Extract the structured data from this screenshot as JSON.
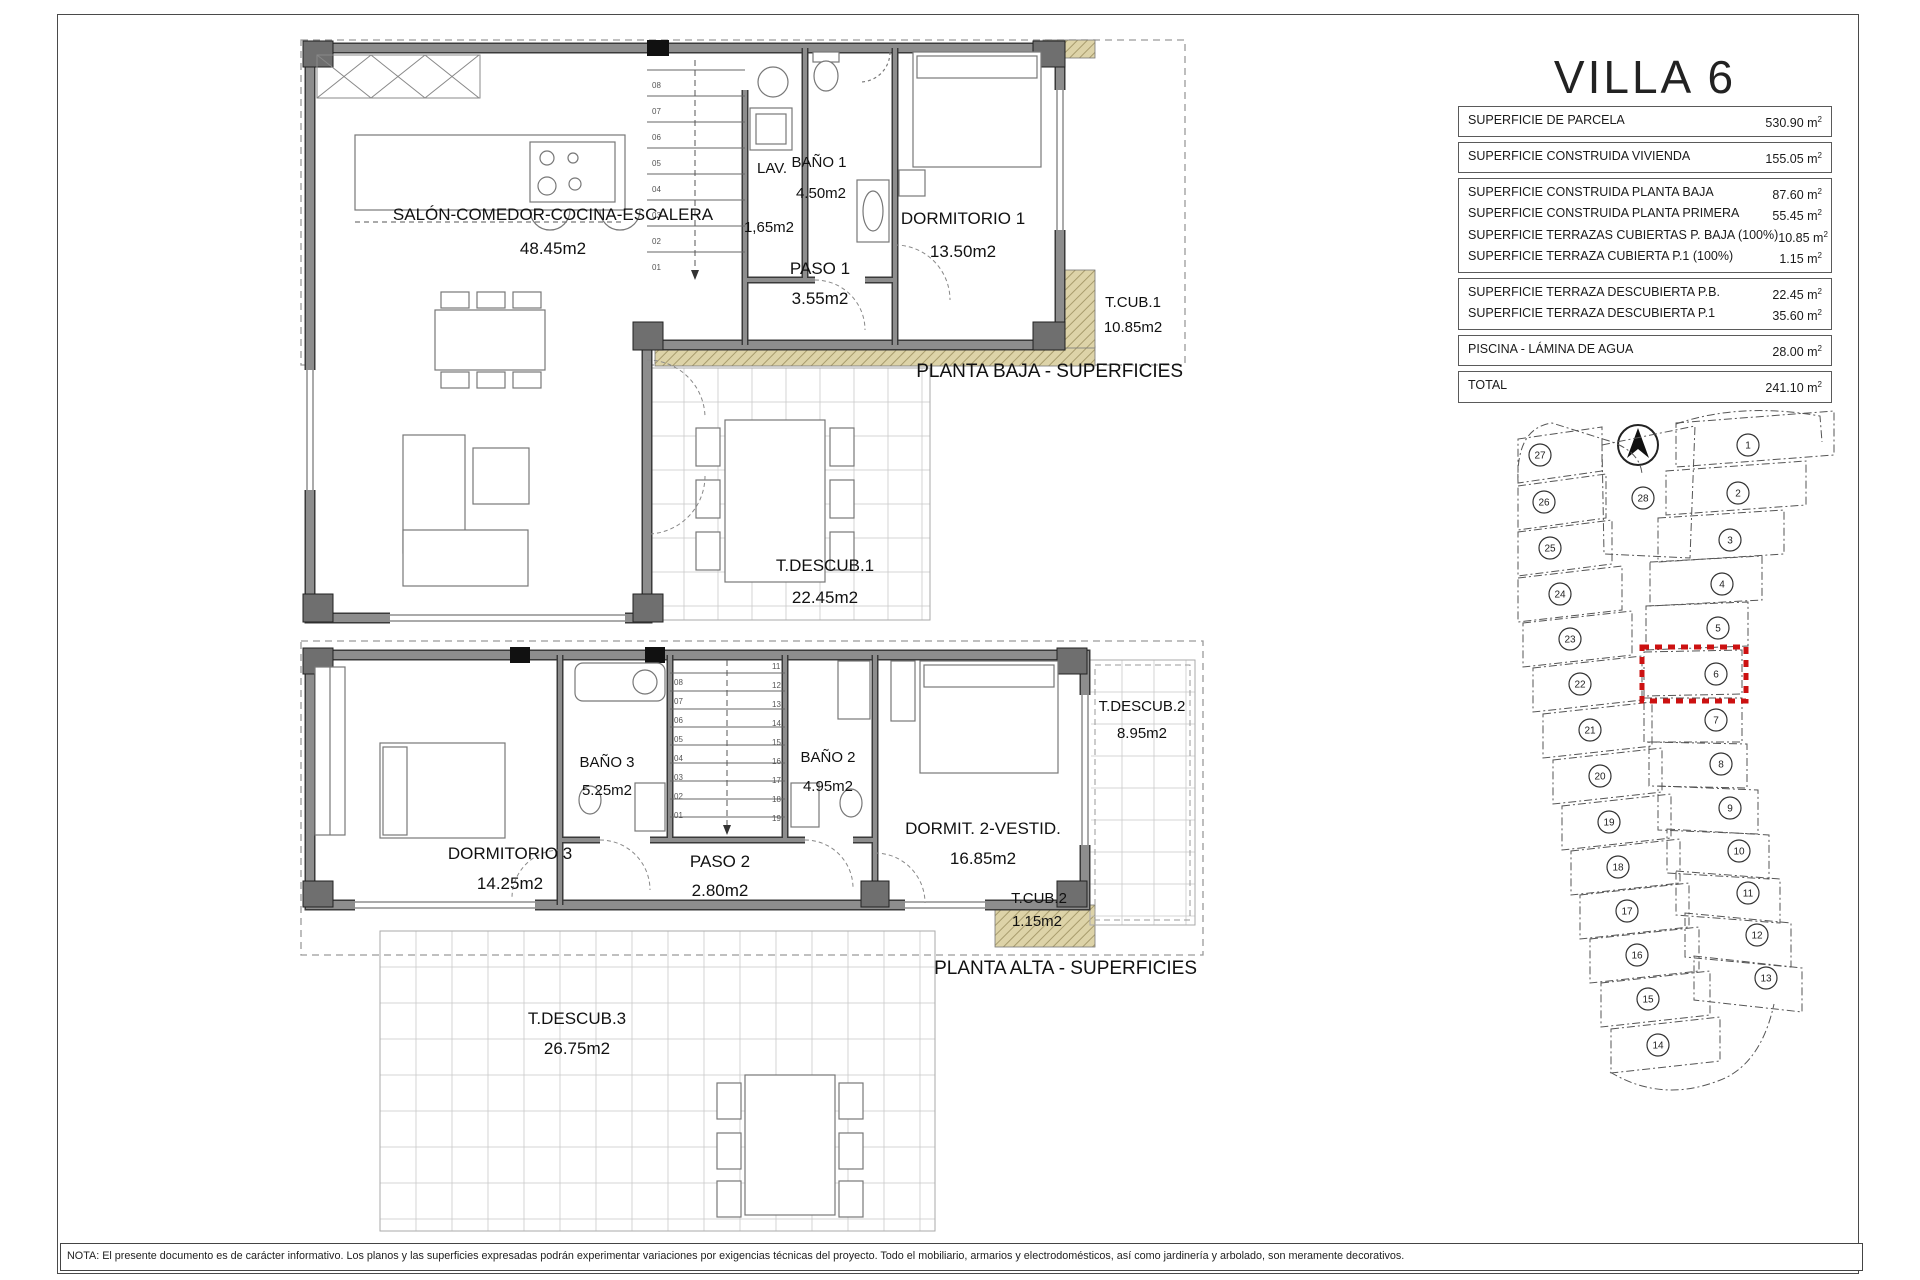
{
  "title": "VILLA 6",
  "table": {
    "unit_suffix": "m",
    "groups": [
      {
        "rows": [
          {
            "label": "SUPERFICIE DE PARCELA",
            "value": "530.90"
          }
        ]
      },
      {
        "rows": [
          {
            "label": "SUPERFICIE CONSTRUIDA VIVIENDA",
            "value": "155.05"
          }
        ]
      },
      {
        "rows": [
          {
            "label": "SUPERFICIE CONSTRUIDA PLANTA BAJA",
            "value": "87.60"
          },
          {
            "label": "SUPERFICIE CONSTRUIDA PLANTA PRIMERA",
            "value": "55.45"
          },
          {
            "label": "SUPERFICIE TERRAZAS CUBIERTAS P. BAJA (100%)",
            "value": "10.85"
          },
          {
            "label": "SUPERFICIE TERRAZA CUBIERTA P.1 (100%)",
            "value": "1.15"
          }
        ]
      },
      {
        "rows": [
          {
            "label": "SUPERFICIE TERRAZA DESCUBIERTA P.B.",
            "value": "22.45"
          },
          {
            "label": "SUPERFICIE TERRAZA DESCUBIERTA P.1",
            "value": "35.60"
          }
        ]
      },
      {
        "rows": [
          {
            "label": "PISCINA - LÁMINA DE AGUA",
            "value": "28.00"
          }
        ]
      },
      {
        "rows": [
          {
            "label": "TOTAL",
            "value": "241.10"
          }
        ]
      }
    ]
  },
  "plans": {
    "baja": {
      "caption": "PLANTA BAJA - SUPERFICIES",
      "rooms": {
        "salon": {
          "name": "SALÓN-COMEDOR-COCINA-ESCALERA",
          "area": "48.45m2"
        },
        "lav": {
          "name": "LAV.",
          "area": "1,65m2"
        },
        "bano1": {
          "name": "BAÑO 1",
          "area": "4.50m2"
        },
        "paso1": {
          "name": "PASO 1",
          "area": "3.55m2"
        },
        "dormitorio1": {
          "name": "DORMITORIO 1",
          "area": "13.50m2"
        },
        "tcub1": {
          "name": "T.CUB.1",
          "area": "10.85m2"
        },
        "tdescub1": {
          "name": "T.DESCUB.1",
          "area": "22.45m2"
        }
      },
      "stair_numbers": [
        "01",
        "02",
        "03",
        "04",
        "05",
        "06",
        "07",
        "08"
      ]
    },
    "alta": {
      "caption": "PLANTA ALTA - SUPERFICIES",
      "rooms": {
        "dormitorio3": {
          "name": "DORMITORIO 3",
          "area": "14.25m2"
        },
        "bano3": {
          "name": "BAÑO 3",
          "area": "5.25m2"
        },
        "paso2": {
          "name": "PASO 2",
          "area": "2.80m2"
        },
        "bano2": {
          "name": "BAÑO 2",
          "area": "4.95m2"
        },
        "dormitorio2": {
          "name": "DORMIT. 2-VESTID.",
          "area": "16.85m2"
        },
        "tdescub2": {
          "name": "T.DESCUB.2",
          "area": "8.95m2"
        },
        "tcub2": {
          "name": "T.CUB.2",
          "area": "1.15m2"
        },
        "tdescub3": {
          "name": "T.DESCUB.3",
          "area": "26.75m2"
        }
      },
      "stair_numbers_left": [
        "01",
        "02",
        "03",
        "04",
        "05",
        "06",
        "07",
        "08"
      ],
      "stair_numbers_right": [
        "11",
        "12",
        "13",
        "14",
        "15",
        "16",
        "17",
        "18",
        "19"
      ]
    }
  },
  "site_plan": {
    "highlighted_plot": "6",
    "center_plot": "28",
    "left_plots": [
      "27",
      "26",
      "25",
      "24",
      "23",
      "22",
      "21",
      "20",
      "19",
      "18",
      "17",
      "16",
      "15",
      "14"
    ],
    "right_plots": [
      "1",
      "2",
      "3",
      "4",
      "5",
      "6",
      "7",
      "8",
      "9",
      "10",
      "11",
      "12",
      "13"
    ]
  },
  "note": "NOTA: El presente documento es de carácter informativo. Los planos y las superficies expresadas podrán experimentar variaciones por exigencias técnicas del proyecto. Todo el mobiliario, armarios y electrodomésticos, así como jardinería y arbolado, son meramente decorativos.",
  "colors": {
    "wall": "#8d8d8d",
    "wall_edge": "#3a3a3a",
    "hatch_fill": "#ddd3a8",
    "hatch_line": "#a89c6d",
    "highlight": "#cc1111",
    "grid": "#c9c9c9"
  }
}
